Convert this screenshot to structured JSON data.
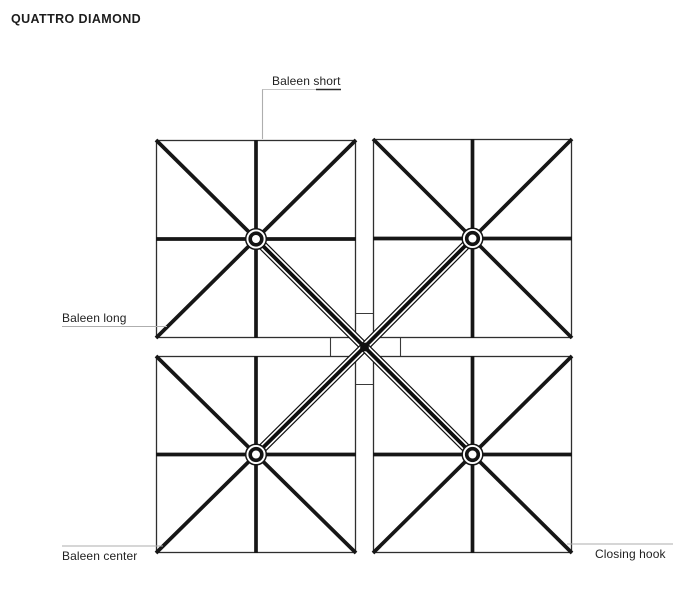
{
  "title": "QUATTRO DIAMOND",
  "labels": {
    "baleen_short": "Baleen short",
    "baleen_long": "Baleen long",
    "baleen_center": "Baleen center",
    "closing_hook": "Closing hook"
  },
  "diagram": {
    "type": "top-view technical line drawing of quad parasol",
    "canopy_count": 4,
    "parts": [
      "baleen short",
      "baleen long",
      "baleen center",
      "closing hook",
      "hub",
      "mast",
      "support arm"
    ],
    "colors": {
      "ink": "#161616",
      "outline": "#2f2f2f",
      "leader": "#aeaeae",
      "background": "#ffffff"
    }
  }
}
